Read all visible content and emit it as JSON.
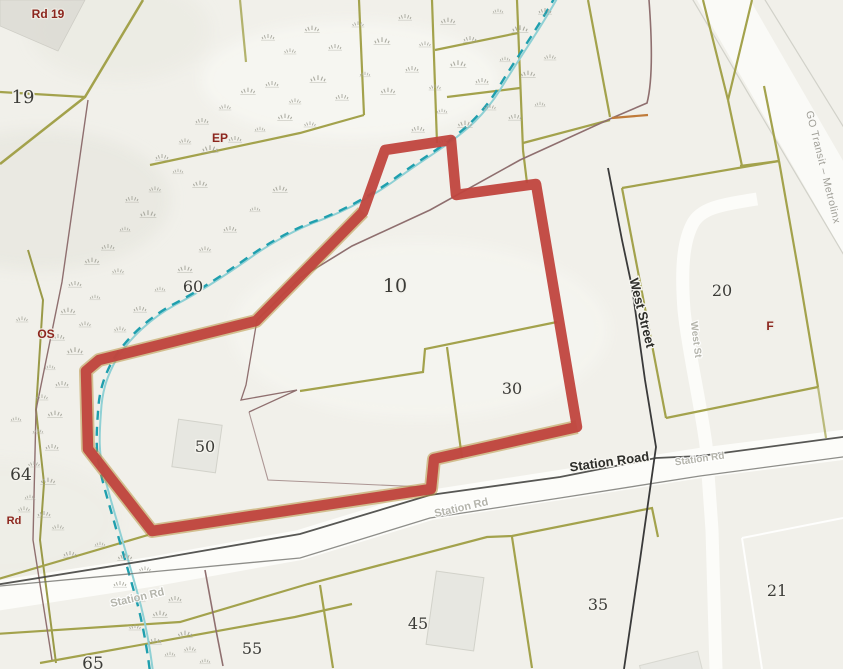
{
  "map": {
    "parcel_labels": [
      {
        "text": "19",
        "x": 23,
        "y": 103,
        "size": 18
      },
      {
        "text": "60",
        "x": 193,
        "y": 292,
        "size": 16
      },
      {
        "text": "10",
        "x": 395,
        "y": 292,
        "size": 19
      },
      {
        "text": "30",
        "x": 512,
        "y": 394,
        "size": 16
      },
      {
        "text": "50",
        "x": 205,
        "y": 452,
        "size": 16
      },
      {
        "text": "64",
        "x": 21,
        "y": 480,
        "size": 17
      },
      {
        "text": "20",
        "x": 722,
        "y": 296,
        "size": 16
      },
      {
        "text": "21",
        "x": 777,
        "y": 596,
        "size": 16
      },
      {
        "text": "35",
        "x": 598,
        "y": 610,
        "size": 16
      },
      {
        "text": "45",
        "x": 418,
        "y": 629,
        "size": 16
      },
      {
        "text": "55",
        "x": 252,
        "y": 654,
        "size": 16
      },
      {
        "text": "65",
        "x": 93,
        "y": 669,
        "size": 17
      }
    ],
    "zone_labels": [
      {
        "text": "Rd 19",
        "x": 48,
        "y": 18,
        "size": 12
      },
      {
        "text": "EP",
        "x": 220,
        "y": 142,
        "size": 12
      },
      {
        "text": "OS",
        "x": 46,
        "y": 338,
        "size": 12
      },
      {
        "text": "Rd",
        "x": 14,
        "y": 524,
        "size": 11
      },
      {
        "text": "F",
        "x": 770,
        "y": 330,
        "size": 12
      }
    ],
    "street_labels": [
      {
        "text": "Station Road",
        "x": 610,
        "y": 466,
        "rotate": -8,
        "size": 13,
        "style": "black"
      },
      {
        "text": "Station Rd",
        "x": 462,
        "y": 511,
        "rotate": -13,
        "size": 11,
        "style": "faded"
      },
      {
        "text": "Station Rd",
        "x": 138,
        "y": 601,
        "rotate": -13,
        "size": 11,
        "style": "faded"
      },
      {
        "text": "Station Rd",
        "x": 700,
        "y": 462,
        "rotate": -8,
        "size": 10,
        "style": "faded"
      },
      {
        "text": "West Street",
        "x": 638,
        "y": 314,
        "rotate": 76,
        "size": 13,
        "style": "black"
      },
      {
        "text": "West St",
        "x": 693,
        "y": 340,
        "rotate": 83,
        "size": 10,
        "style": "faded"
      },
      {
        "text": "GO Transit – Metrolinx",
        "x": 820,
        "y": 168,
        "rotate": 76,
        "size": 10.5,
        "style": "gray"
      }
    ],
    "colors": {
      "background": "#f1f0ea",
      "selected_boundary": "#c0453e",
      "parcel_line_olive": "#a3a24c",
      "creek_dash": "#1f9fae",
      "creek_solid": "#8fd0d4",
      "fence_maroon": "#8f6f6f",
      "road_fill": "#fcfcf9",
      "road_edge_black": "#454541"
    },
    "tufts": [
      [
        545,
        12,
        1
      ],
      [
        520,
        30,
        1.2
      ],
      [
        498,
        12,
        0.8
      ],
      [
        470,
        40,
        1
      ],
      [
        448,
        22,
        1.1
      ],
      [
        425,
        45,
        0.9
      ],
      [
        405,
        18,
        1
      ],
      [
        382,
        42,
        1.2
      ],
      [
        358,
        25,
        0.9
      ],
      [
        335,
        48,
        1
      ],
      [
        312,
        30,
        1.1
      ],
      [
        290,
        52,
        0.9
      ],
      [
        268,
        38,
        1
      ],
      [
        550,
        58,
        0.9
      ],
      [
        528,
        75,
        1.1
      ],
      [
        505,
        60,
        0.8
      ],
      [
        482,
        82,
        1
      ],
      [
        458,
        65,
        1.2
      ],
      [
        435,
        88,
        0.9
      ],
      [
        412,
        70,
        1
      ],
      [
        388,
        92,
        1.1
      ],
      [
        365,
        75,
        0.8
      ],
      [
        342,
        98,
        1
      ],
      [
        318,
        80,
        1.2
      ],
      [
        295,
        102,
        0.9
      ],
      [
        272,
        85,
        1
      ],
      [
        248,
        92,
        1.1
      ],
      [
        225,
        108,
        0.9
      ],
      [
        202,
        122,
        1
      ],
      [
        540,
        105,
        0.8
      ],
      [
        515,
        118,
        1
      ],
      [
        490,
        108,
        0.9
      ],
      [
        465,
        125,
        1.1
      ],
      [
        442,
        112,
        0.8
      ],
      [
        418,
        130,
        1
      ],
      [
        445,
        142,
        0.9
      ],
      [
        310,
        125,
        0.9
      ],
      [
        285,
        118,
        1.1
      ],
      [
        260,
        130,
        0.8
      ],
      [
        235,
        140,
        1
      ],
      [
        210,
        150,
        1.2
      ],
      [
        185,
        142,
        0.9
      ],
      [
        162,
        158,
        1
      ],
      [
        178,
        172,
        0.8
      ],
      [
        200,
        185,
        1.1
      ],
      [
        155,
        190,
        0.9
      ],
      [
        132,
        200,
        1
      ],
      [
        148,
        215,
        1.2
      ],
      [
        125,
        230,
        0.8
      ],
      [
        108,
        248,
        1
      ],
      [
        92,
        262,
        1.1
      ],
      [
        118,
        272,
        0.9
      ],
      [
        75,
        285,
        1
      ],
      [
        95,
        298,
        0.8
      ],
      [
        68,
        312,
        1.1
      ],
      [
        85,
        325,
        0.9
      ],
      [
        58,
        338,
        1
      ],
      [
        75,
        352,
        1.2
      ],
      [
        50,
        368,
        0.8
      ],
      [
        62,
        385,
        1
      ],
      [
        42,
        398,
        0.9
      ],
      [
        55,
        415,
        1.1
      ],
      [
        38,
        432,
        0.8
      ],
      [
        52,
        448,
        1
      ],
      [
        34,
        465,
        0.9
      ],
      [
        48,
        482,
        1.1
      ],
      [
        30,
        498,
        0.8
      ],
      [
        44,
        515,
        1
      ],
      [
        58,
        528,
        0.9
      ],
      [
        22,
        320,
        0.9
      ],
      [
        16,
        420,
        0.8
      ],
      [
        24,
        510,
        0.9
      ],
      [
        70,
        555,
        1
      ],
      [
        100,
        545,
        0.8
      ],
      [
        125,
        558,
        1.1
      ],
      [
        145,
        570,
        0.9
      ],
      [
        120,
        585,
        1
      ],
      [
        140,
        600,
        0.8
      ],
      [
        160,
        615,
        1.1
      ],
      [
        135,
        628,
        0.9
      ],
      [
        155,
        642,
        1
      ],
      [
        170,
        655,
        0.8
      ],
      [
        185,
        635,
        1.1
      ],
      [
        175,
        600,
        1
      ],
      [
        190,
        650,
        0.9
      ],
      [
        205,
        662,
        0.8
      ],
      [
        120,
        330,
        0.9
      ],
      [
        140,
        310,
        1
      ],
      [
        160,
        290,
        0.8
      ],
      [
        185,
        270,
        1.1
      ],
      [
        205,
        250,
        0.9
      ],
      [
        230,
        230,
        1
      ],
      [
        255,
        210,
        0.8
      ],
      [
        280,
        190,
        1.1
      ]
    ]
  }
}
